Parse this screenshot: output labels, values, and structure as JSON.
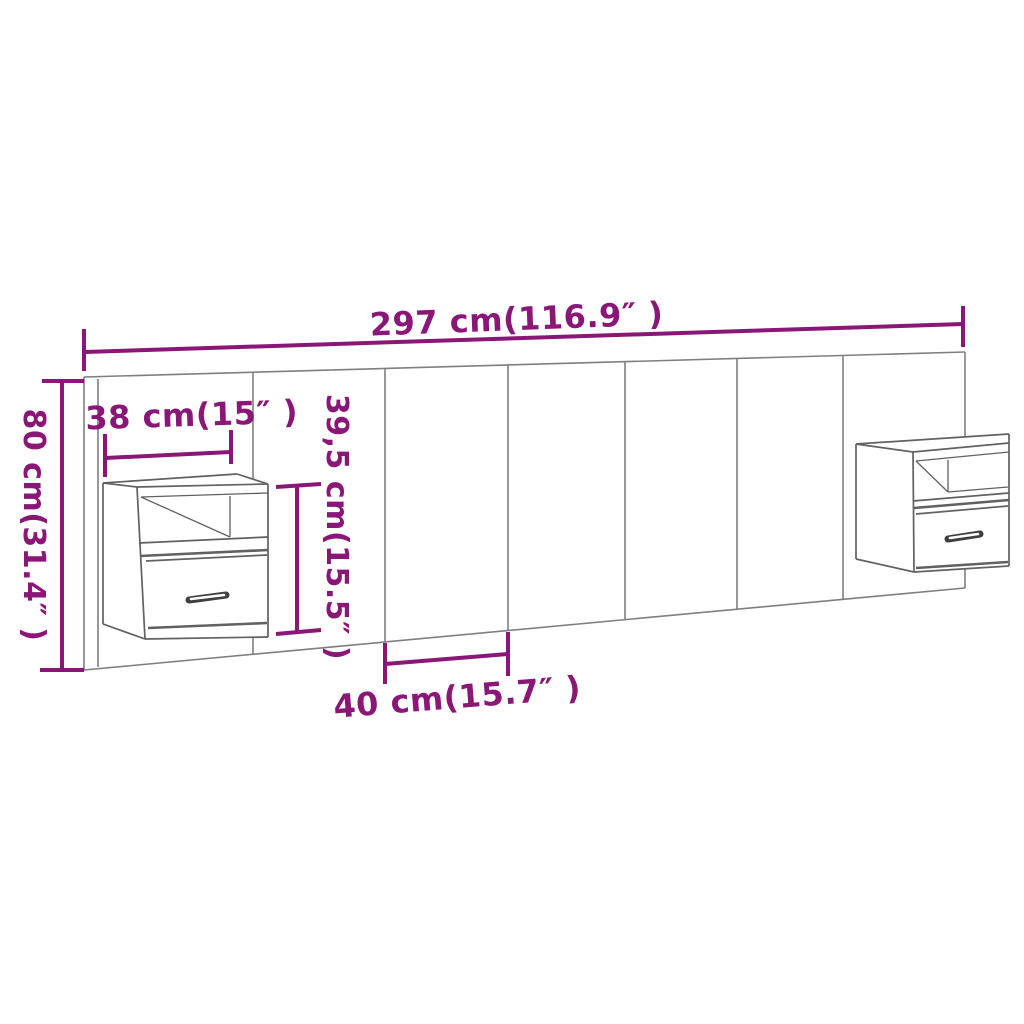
{
  "title": "Headboard with floating cabinets dimension diagram",
  "colors": {
    "dimension": "#8a1677",
    "outline": "#7f7f7f",
    "cabinet-outline": "#616161",
    "handle": "#3f3f3f",
    "background": "#ffffff"
  },
  "dimensions": {
    "total_width": {
      "label": "297 cm(116.9″ )",
      "cm": "297",
      "inches": "116.9"
    },
    "total_height": {
      "label": "80 cm(31.4″ )",
      "cm": "80",
      "inches": "31.4"
    },
    "cabinet_width": {
      "label": "38 cm(15″ )",
      "cm": "38",
      "inches": "15"
    },
    "cabinet_height": {
      "label": "39,5 cm(15.5″ )",
      "cm": "39,5",
      "inches": "15.5"
    },
    "panel_width": {
      "label": "40 cm(15.7″ )",
      "cm": "40",
      "inches": "15.7"
    }
  },
  "objects": {
    "headboard": "headboard panel wall with 7 vertical boards",
    "left_cabinet": "floating bedside cabinet with open shelf and drawer",
    "right_cabinet": "floating bedside cabinet with open shelf and drawer"
  }
}
